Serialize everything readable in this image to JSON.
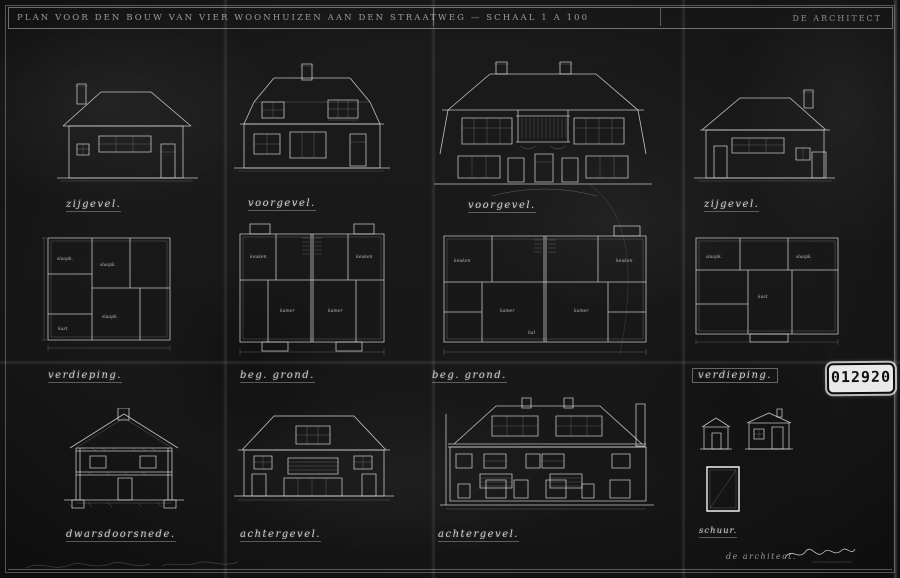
{
  "sheet": {
    "background_color": "#1a1a1a",
    "line_color": "#e0e0e0",
    "header": {
      "title": "PLAN VOOR DEN BOUW VAN VIER WOONHUIZEN AAN DEN STRAATWEG — SCHAAL 1 A 100",
      "title_right": "DE ARCHITECT"
    },
    "stamp": {
      "number": "012920"
    },
    "labels": {
      "elevations": [
        "zijgevel.",
        "voorgevel.",
        "voorgevel.",
        "zijgevel."
      ],
      "plans": [
        "verdieping.",
        "beg. grond.",
        "beg. grond.",
        "verdieping."
      ],
      "bottom": [
        "dwarsdoorsnede.",
        "achtergevel.",
        "achtergevel.",
        "schuur."
      ]
    },
    "room_labels": [
      "kamer",
      "keuken",
      "slaapk.",
      "hal",
      "kast",
      "gang"
    ],
    "footer": {
      "architect": "de architect."
    }
  }
}
